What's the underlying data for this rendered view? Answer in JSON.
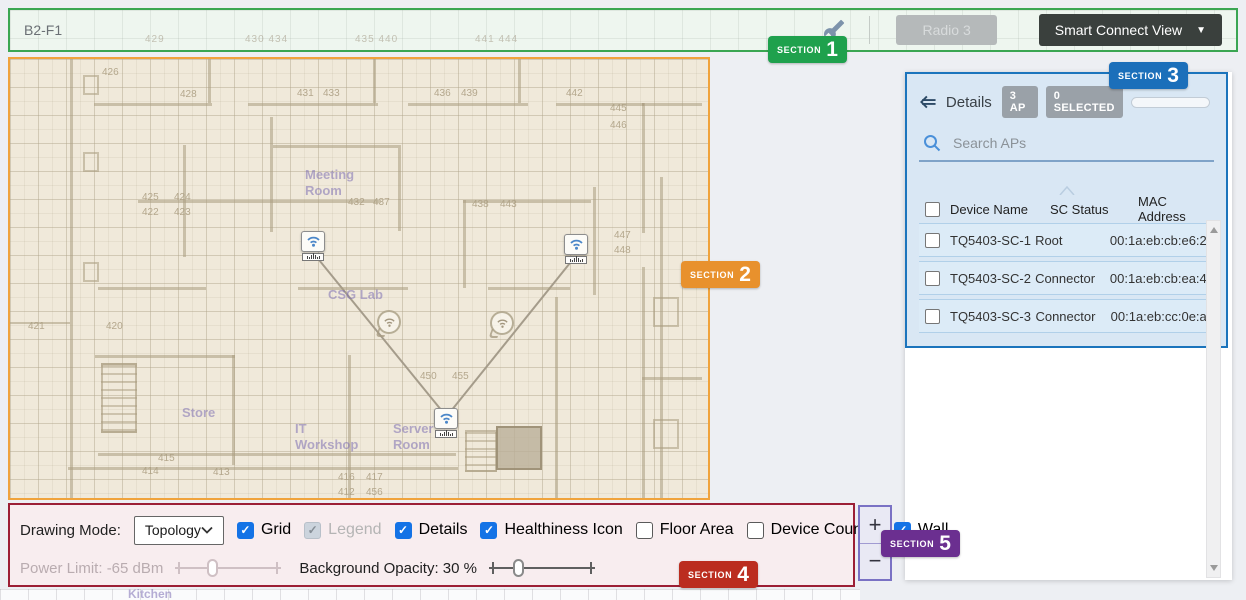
{
  "icons": {
    "caret_down": "▼",
    "checkmark": "✓"
  },
  "section_badges": [
    {
      "label": "SECTION",
      "number": "1",
      "color": "#1fa14d"
    },
    {
      "label": "SECTION",
      "number": "2",
      "color": "#e8912d"
    },
    {
      "label": "SECTION",
      "number": "3",
      "color": "#1b6fba"
    },
    {
      "label": "SECTION",
      "number": "4",
      "color": "#bb2d1f"
    },
    {
      "label": "SECTION",
      "number": "5",
      "color": "#6b2f90"
    }
  ],
  "topbar": {
    "title": "B2-F1",
    "radio_button_label": "Radio 3",
    "view_dropdown_label": "Smart Connect View",
    "faint_numbers": [
      "429",
      "430 434",
      "435 440",
      "441 444"
    ]
  },
  "map": {
    "background": "#f0e9da",
    "border_color": "#f0a33c",
    "kitchen_label": "Kitchen",
    "room_labels": [
      {
        "t": "Meeting Room",
        "x": 295,
        "y": 108,
        "w": 64
      },
      {
        "t": "CSG Lab",
        "x": 318,
        "y": 228,
        "w": 80
      },
      {
        "t": "IT Workshop",
        "x": 285,
        "y": 362,
        "w": 72
      },
      {
        "t": "Server Room",
        "x": 383,
        "y": 362,
        "w": 58
      },
      {
        "t": "Store",
        "x": 172,
        "y": 346,
        "w": 50
      }
    ],
    "room_numbers": [
      {
        "t": "426",
        "x": 92,
        "y": 8
      },
      {
        "t": "428",
        "x": 170,
        "y": 30
      },
      {
        "t": "431",
        "x": 287,
        "y": 29
      },
      {
        "t": "433",
        "x": 313,
        "y": 29
      },
      {
        "t": "436",
        "x": 424,
        "y": 29
      },
      {
        "t": "439",
        "x": 451,
        "y": 29
      },
      {
        "t": "442",
        "x": 556,
        "y": 29
      },
      {
        "t": "445",
        "x": 600,
        "y": 44
      },
      {
        "t": "446",
        "x": 600,
        "y": 61
      },
      {
        "t": "425",
        "x": 132,
        "y": 133
      },
      {
        "t": "424",
        "x": 164,
        "y": 133
      },
      {
        "t": "422",
        "x": 132,
        "y": 148
      },
      {
        "t": "423",
        "x": 164,
        "y": 148
      },
      {
        "t": "432",
        "x": 338,
        "y": 138
      },
      {
        "t": "437",
        "x": 363,
        "y": 138
      },
      {
        "t": "438",
        "x": 462,
        "y": 140
      },
      {
        "t": "443",
        "x": 490,
        "y": 140
      },
      {
        "t": "447",
        "x": 604,
        "y": 171
      },
      {
        "t": "448",
        "x": 604,
        "y": 186
      },
      {
        "t": "450",
        "x": 410,
        "y": 312
      },
      {
        "t": "455",
        "x": 442,
        "y": 312
      },
      {
        "t": "421",
        "x": 18,
        "y": 262
      },
      {
        "t": "420",
        "x": 96,
        "y": 262
      },
      {
        "t": "415",
        "x": 148,
        "y": 394
      },
      {
        "t": "414",
        "x": 132,
        "y": 407
      },
      {
        "t": "413",
        "x": 203,
        "y": 408
      },
      {
        "t": "416",
        "x": 328,
        "y": 413
      },
      {
        "t": "417",
        "x": 356,
        "y": 413
      },
      {
        "t": "412",
        "x": 328,
        "y": 428
      },
      {
        "t": "456",
        "x": 356,
        "y": 428
      }
    ],
    "aps": [
      {
        "x": 303,
        "y": 182
      },
      {
        "x": 566,
        "y": 185
      },
      {
        "x": 436,
        "y": 359
      }
    ],
    "links": [
      {
        "x1": 305,
        "y1": 196,
        "x2": 432,
        "y2": 352
      },
      {
        "x1": 564,
        "y1": 199,
        "x2": 441,
        "y2": 352
      }
    ],
    "bubble_icons": [
      {
        "x": 379,
        "y": 263
      },
      {
        "x": 492,
        "y": 264
      }
    ]
  },
  "details_panel": {
    "title": "Details",
    "ap_count_badge": "3 AP",
    "selected_badge": "0 SELECTED",
    "progress_percent": 62,
    "progress_color": "#1473e6",
    "search_placeholder": "Search APs",
    "table": {
      "columns": [
        "Device Name",
        "SC Status",
        "MAC Address"
      ],
      "rows": [
        {
          "device": "TQ5403-SC-1",
          "status": "Root",
          "mac": "00:1a:eb:cb:e6:20"
        },
        {
          "device": "TQ5403-SC-2",
          "status": "Connector",
          "mac": "00:1a:eb:cb:ea:40"
        },
        {
          "device": "TQ5403-SC-3",
          "status": "Connector",
          "mac": "00:1a:eb:cc:0e:a0"
        }
      ]
    }
  },
  "toolbar": {
    "drawing_mode_label": "Drawing Mode:",
    "drawing_mode_value": "Topology",
    "checkboxes": [
      {
        "label": "Grid",
        "checked": true,
        "disabled": false
      },
      {
        "label": "Legend",
        "checked": true,
        "disabled": true
      },
      {
        "label": "Details",
        "checked": true,
        "disabled": false
      },
      {
        "label": "Healthiness Icon",
        "checked": true,
        "disabled": false
      },
      {
        "label": "Floor Area",
        "checked": false,
        "disabled": false
      },
      {
        "label": "Device Counter",
        "checked": false,
        "disabled": false
      },
      {
        "label": "Wall",
        "checked": true,
        "disabled": false
      }
    ],
    "power_limit_label": "Power Limit: -65 dBm",
    "power_limit_thumb_percent": 30,
    "power_limit_disabled": true,
    "background_opacity_label": "Background Opacity: 30 %",
    "background_opacity_thumb_percent": 23
  },
  "zoom_controls": {
    "zoom_in": "+",
    "zoom_out": "−"
  }
}
